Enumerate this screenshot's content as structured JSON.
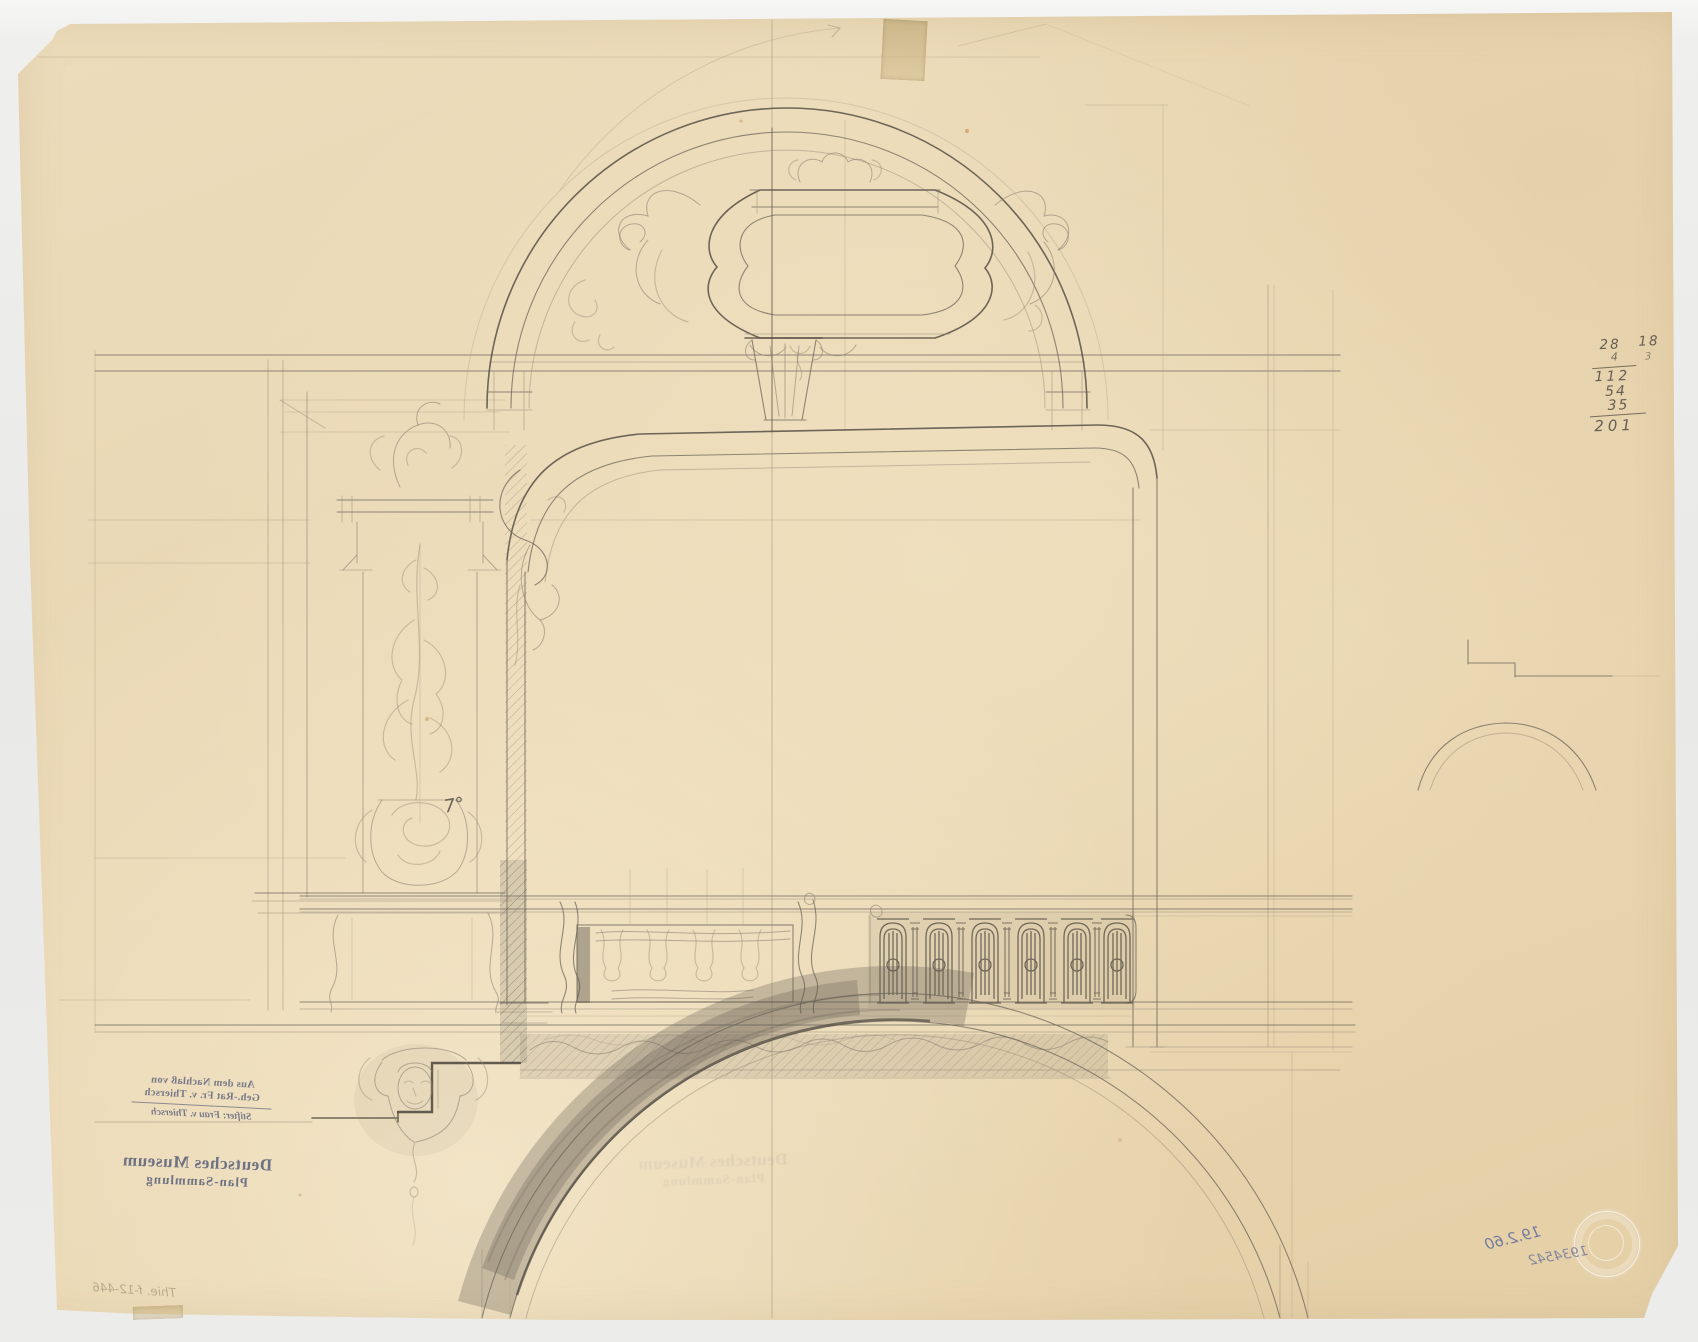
{
  "colors": {
    "paper": "#ebdab8",
    "pencil": "#6e665b",
    "graphite_shading": "#6f675d",
    "stamp_ink": "#565f8a",
    "pen_ink": "#5f6ca0",
    "scanner_bed": "#ededeb"
  },
  "stamps": {
    "provenance": {
      "mirrored": true,
      "line1": "Aus dem Nachlaß von",
      "line2": "Geh.-Rat Fr. v. Thiersch",
      "line3": "Stifter: Frau v. Thiersch"
    },
    "museum": {
      "mirrored": true,
      "line1": "Deutsches Museum",
      "line2": "Plan-Sammlung"
    }
  },
  "annotations": {
    "pencil_sum": {
      "f1": "28",
      "f2": "18",
      "f3": "4",
      "f4": "3",
      "t1": "112",
      "t2": "54",
      "t3": "35",
      "total": "201"
    },
    "angle_note": "7°",
    "pen_date_note": "19.2.60",
    "pen_number_note": "1934542",
    "pencil_signature_note": "Thie. f-12-446"
  }
}
